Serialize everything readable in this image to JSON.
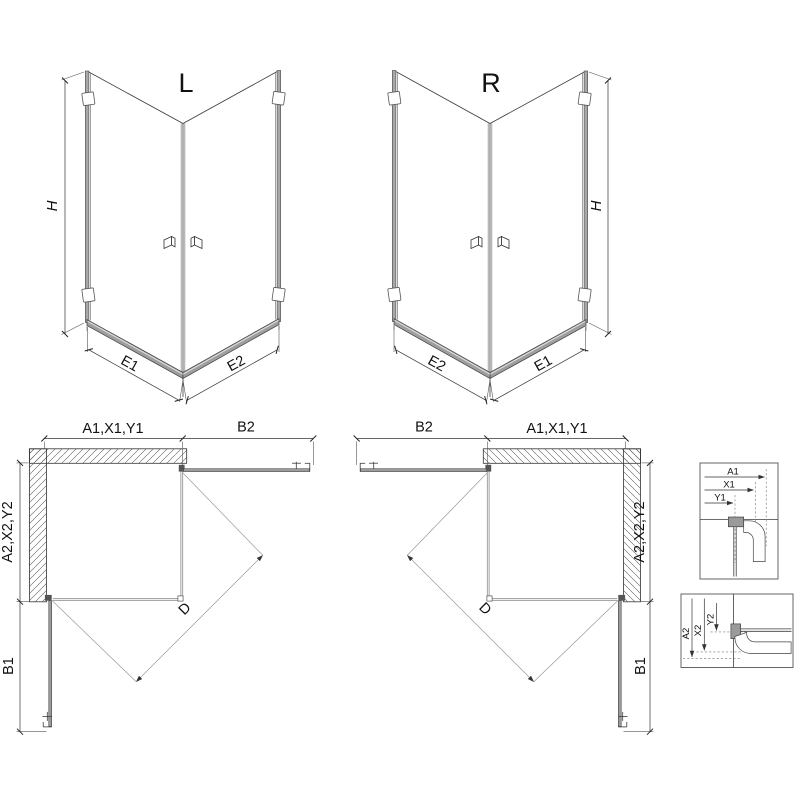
{
  "drawing": {
    "type": "shower-enclosure-technical-drawing",
    "views": {
      "iso_left": {
        "label": "L",
        "height_dim": "H",
        "bottom_left_dim": "E1",
        "bottom_right_dim": "E2"
      },
      "iso_right": {
        "label": "R",
        "height_dim": "H",
        "bottom_left_dim": "E2",
        "bottom_right_dim": "E1"
      },
      "plan_left": {
        "width_dim": "A1,X1,Y1",
        "door_dim": "B2",
        "depth_dim": "A2,X2,Y2",
        "side_door_dim": "B1",
        "diagonal_dim": "D"
      },
      "plan_right": {
        "width_dim": "A1,X1,Y1",
        "door_dim": "B2",
        "depth_dim": "A2,X2,Y2",
        "side_door_dim": "B1",
        "diagonal_dim": "D"
      },
      "detail_top": {
        "dim_a": "A1",
        "dim_x": "X1",
        "dim_y": "Y1"
      },
      "detail_bottom": {
        "dim_a": "A2",
        "dim_x": "X2",
        "dim_y": "Y2"
      }
    },
    "colors": {
      "line": "#3d3d3d",
      "profile_gray": "#9b9b9b",
      "rail_highlight": "#e0e0e0",
      "background": "#ffffff"
    }
  }
}
